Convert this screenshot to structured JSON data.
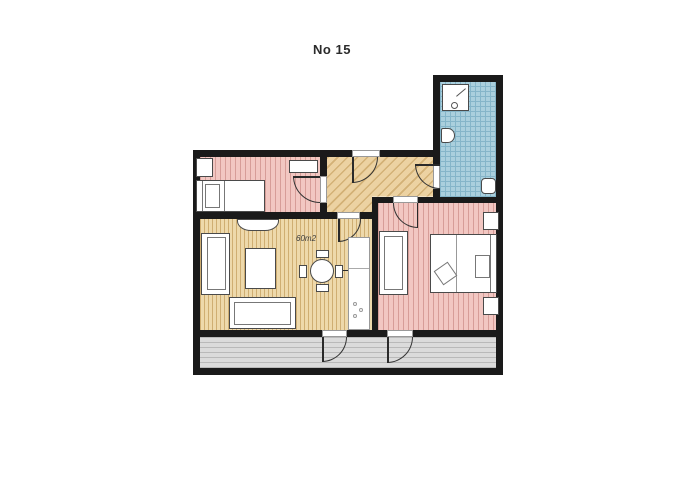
{
  "title": "No 15",
  "floor_plan": {
    "area_label": "60m2",
    "rooms": [
      {
        "id": "bedroom-left",
        "floor_color": "#f2c7c2"
      },
      {
        "id": "hallway",
        "floor_color": "#ecd2a2"
      },
      {
        "id": "bathroom",
        "floor_color": "#aacfdd"
      },
      {
        "id": "bedroom-right",
        "floor_color": "#f2c7c2"
      },
      {
        "id": "living-room",
        "floor_color": "#eed9ab"
      },
      {
        "id": "terrace",
        "floor_color": "#dbdbdb"
      }
    ]
  },
  "palette": {
    "wall": "#1a1a1a",
    "pink": "#f2c7c2",
    "pink_line": "#d79d98",
    "tan": "#eed9ab",
    "tan_line": "#cfae72",
    "hall": "#ecd2a2",
    "hall_line": "#d3b176",
    "blue": "#aacfdd",
    "blue_line": "#85b5c9",
    "gray": "#dbdbdb",
    "gray_line": "#b9b9b9",
    "furniture": "#ffffff",
    "furniture_border": "#4a4a4a",
    "title_color": "#2b2b2b"
  }
}
